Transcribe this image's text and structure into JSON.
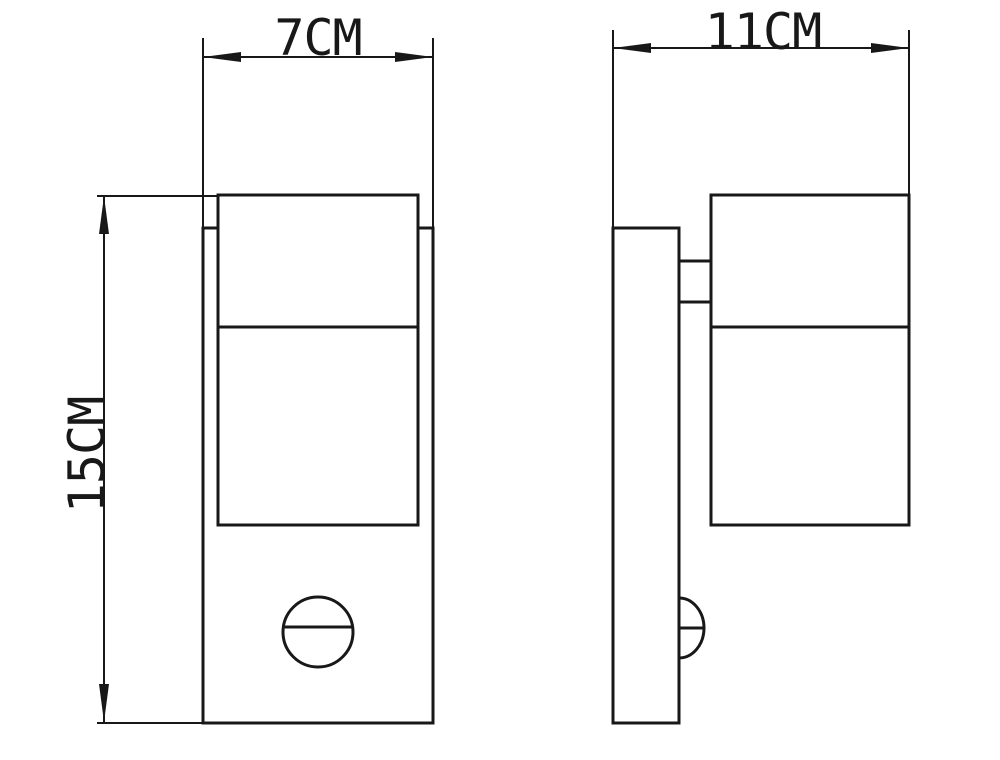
{
  "drawing": {
    "type": "technical-dimension-drawing",
    "subject": "wall-light-with-motion-sensor",
    "colors": {
      "line": "#181818",
      "background": "#ffffff"
    },
    "views": {
      "front": {
        "name": "front-view"
      },
      "side": {
        "name": "side-view"
      }
    }
  },
  "dimensions": {
    "front_width": {
      "label": "7CM",
      "value": 7,
      "unit": "CM"
    },
    "side_depth": {
      "label": "11CM",
      "value": 11,
      "unit": "CM"
    },
    "height": {
      "label": "15CM",
      "value": 15,
      "unit": "CM"
    }
  }
}
